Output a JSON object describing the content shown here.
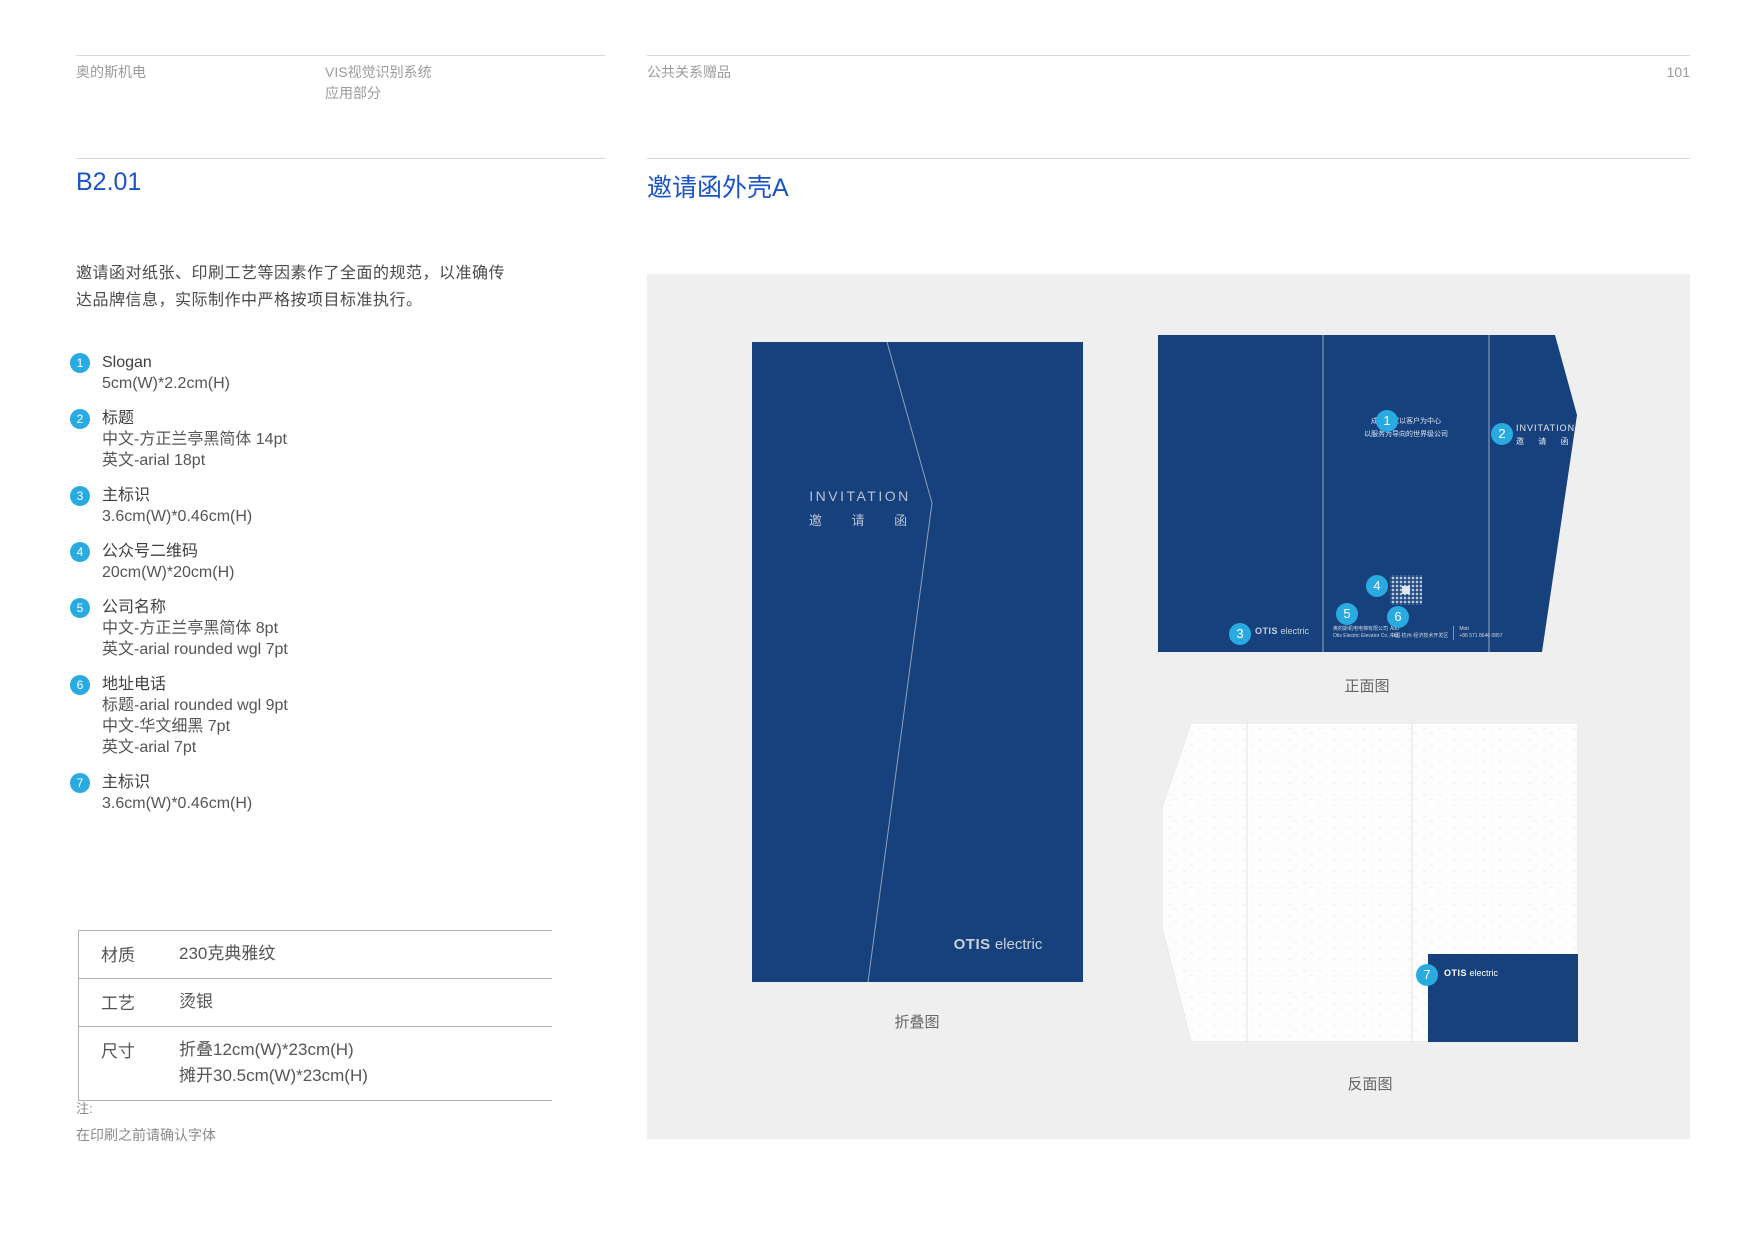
{
  "header": {
    "brand": "奥的斯机电",
    "system_line1": "VIS视觉识别系统",
    "system_line2": "应用部分",
    "section": "公共关系赠品",
    "page_number": "101"
  },
  "left": {
    "code": "B2.01",
    "intro_line1": "邀请函对纸张、印刷工艺等因素作了全面的规范，以准确传",
    "intro_line2": "达品牌信息，实际制作中严格按项目标准执行。",
    "items": [
      {
        "num": "1",
        "label": "Slogan",
        "d1": "5cm(W)*2.2cm(H)",
        "d2": "",
        "d3": ""
      },
      {
        "num": "2",
        "label": "标题",
        "d1": "中文-方正兰亭黑简体  14pt",
        "d2": "英文-arial  18pt",
        "d3": ""
      },
      {
        "num": "3",
        "label": "主标识",
        "d1": "3.6cm(W)*0.46cm(H)",
        "d2": "",
        "d3": ""
      },
      {
        "num": "4",
        "label": "公众号二维码",
        "d1": "20cm(W)*20cm(H)",
        "d2": "",
        "d3": ""
      },
      {
        "num": "5",
        "label": "公司名称",
        "d1": "中文-方正兰亭黑简体  8pt",
        "d2": "英文-arial rounded wgl   7pt",
        "d3": ""
      },
      {
        "num": "6",
        "label": "地址电话",
        "d1": "标题-arial rounded wgl   9pt",
        "d2": "中文-华文细黑  7pt",
        "d3": "英文-arial  7pt"
      },
      {
        "num": "7",
        "label": "主标识",
        "d1": "3.6cm(W)*0.46cm(H)",
        "d2": "",
        "d3": ""
      }
    ],
    "table": {
      "rows": [
        {
          "label": "材质",
          "v1": "230克典雅纹",
          "v2": ""
        },
        {
          "label": "工艺",
          "v1": "烫银",
          "v2": ""
        },
        {
          "label": "尺寸",
          "v1": "折叠12cm(W)*23cm(H)",
          "v2": "摊开30.5cm(W)*23cm(H)"
        }
      ]
    },
    "note_label": "注:",
    "note_text": "在印刷之前请确认字体"
  },
  "right": {
    "title": "邀请函外壳A",
    "folded": {
      "invitation_en": "INVITATION",
      "invitation_cn": "邀 请 函",
      "logo_bold": "OTIS",
      "logo_light": " electric",
      "caption": "折叠图"
    },
    "front": {
      "slogan_line1": "成为一家以客户为中心",
      "slogan_line2": "以服务为导向的世界级公司",
      "invitation_en": "INVITATION",
      "invitation_cn": "邀 请 函",
      "logo_bold": "OTIS",
      "logo_light": " electric",
      "company_cn": "奥的斯机电电梯有限公司",
      "company_en": "Otis Electric Elevator Co., Ltd.",
      "addr_label": "Add",
      "addr_text": "中国·杭州·经济技术开发区",
      "mob_label": "Mob",
      "mob_text": "+86 571 8646 0857",
      "caption": "正面图"
    },
    "back": {
      "logo_bold": "OTIS",
      "logo_light": " electric",
      "caption": "反面图"
    }
  },
  "markers": {
    "m1": "1",
    "m2": "2",
    "m3": "3",
    "m4": "4",
    "m5": "5",
    "m6": "6",
    "m7": "7"
  },
  "colors": {
    "navy": "#17417d",
    "accent_circle": "#29abe2",
    "heading_blue": "#1b54c8",
    "panel_background": "#efefef"
  }
}
